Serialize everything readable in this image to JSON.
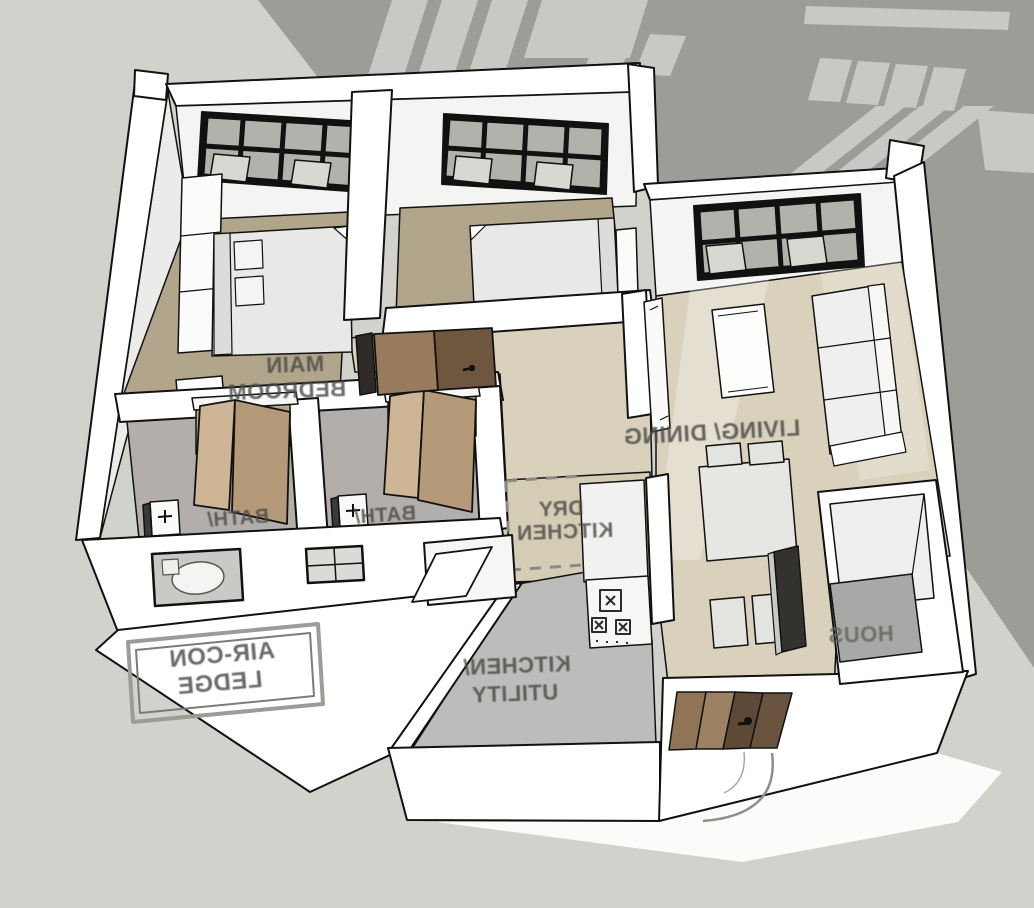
{
  "meta": {
    "scene": "3D axonometric cutaway floor plan of an apartment unit (SketchUp-style render)",
    "text_mirrored": true,
    "background_note": "building shadow with lit window patches cast on ground behind unit"
  },
  "labels": {
    "main_bedroom": {
      "lines": [
        "MAIN",
        "BEDROOM"
      ]
    },
    "bath_1": {
      "lines": [
        "BATH/"
      ]
    },
    "bath_2": {
      "lines": [
        "BATH/"
      ]
    },
    "living_dining": {
      "lines": [
        "LIVING/ DINING"
      ]
    },
    "dry_kitchen": {
      "lines": [
        "DRY",
        "KITCHEN"
      ]
    },
    "kitchen_utility": {
      "lines": [
        "KITCHEN/",
        "UTILITY"
      ]
    },
    "aircon_ledge": {
      "lines": [
        "AIR-CON",
        "LEDGE"
      ]
    },
    "household_shelter": {
      "lines": [
        "HOUS"
      ]
    }
  },
  "rooms": [
    {
      "name": "Main Bedroom",
      "furniture": [
        "double bed",
        "wardrobe",
        "dresser"
      ],
      "window": true
    },
    {
      "name": "Bedroom 2",
      "furniture": [
        "bed",
        "bedside cabinet"
      ],
      "window": true
    },
    {
      "name": "Living/ Dining",
      "furniture": [
        "sofa",
        "coffee table",
        "tv console",
        "dining table",
        "4 chairs"
      ],
      "window": true
    },
    {
      "name": "Bath 1",
      "furniture": [
        "bi-fold door",
        "shower screen"
      ]
    },
    {
      "name": "Bath 2",
      "furniture": [
        "bi-fold door",
        "shower screen"
      ]
    },
    {
      "name": "Dry Kitchen",
      "furniture": [
        "counter",
        "gas hob"
      ]
    },
    {
      "name": "Kitchen/ Utility",
      "furniture": [
        "service window"
      ]
    },
    {
      "name": "Household Shelter",
      "furniture": []
    },
    {
      "name": "Air-con Ledge",
      "furniture": [
        "label plate"
      ]
    },
    {
      "name": "Entrance",
      "furniture": [
        "timber entrance door",
        "door swing arc"
      ]
    }
  ],
  "colors": {
    "background": "#d2d2cc",
    "shadow": "#9c9c98",
    "shadow_light_patch": "#c8c8c4",
    "wall_white": "#ffffff",
    "wall_shade": "#ececea",
    "bedroom_floor": "#b1a58b",
    "living_floor": "#d9d1bc",
    "bath_floor": "#b2aeab",
    "kitchen_floor": "#bcbcba",
    "shelter_floor": "#a8a8a6",
    "door_wood_dark": "#6e563f",
    "door_wood_light": "#977b5c",
    "bifold_wood": "#cdb595",
    "window_frame": "#111111",
    "label_text": "#4a4a47"
  }
}
